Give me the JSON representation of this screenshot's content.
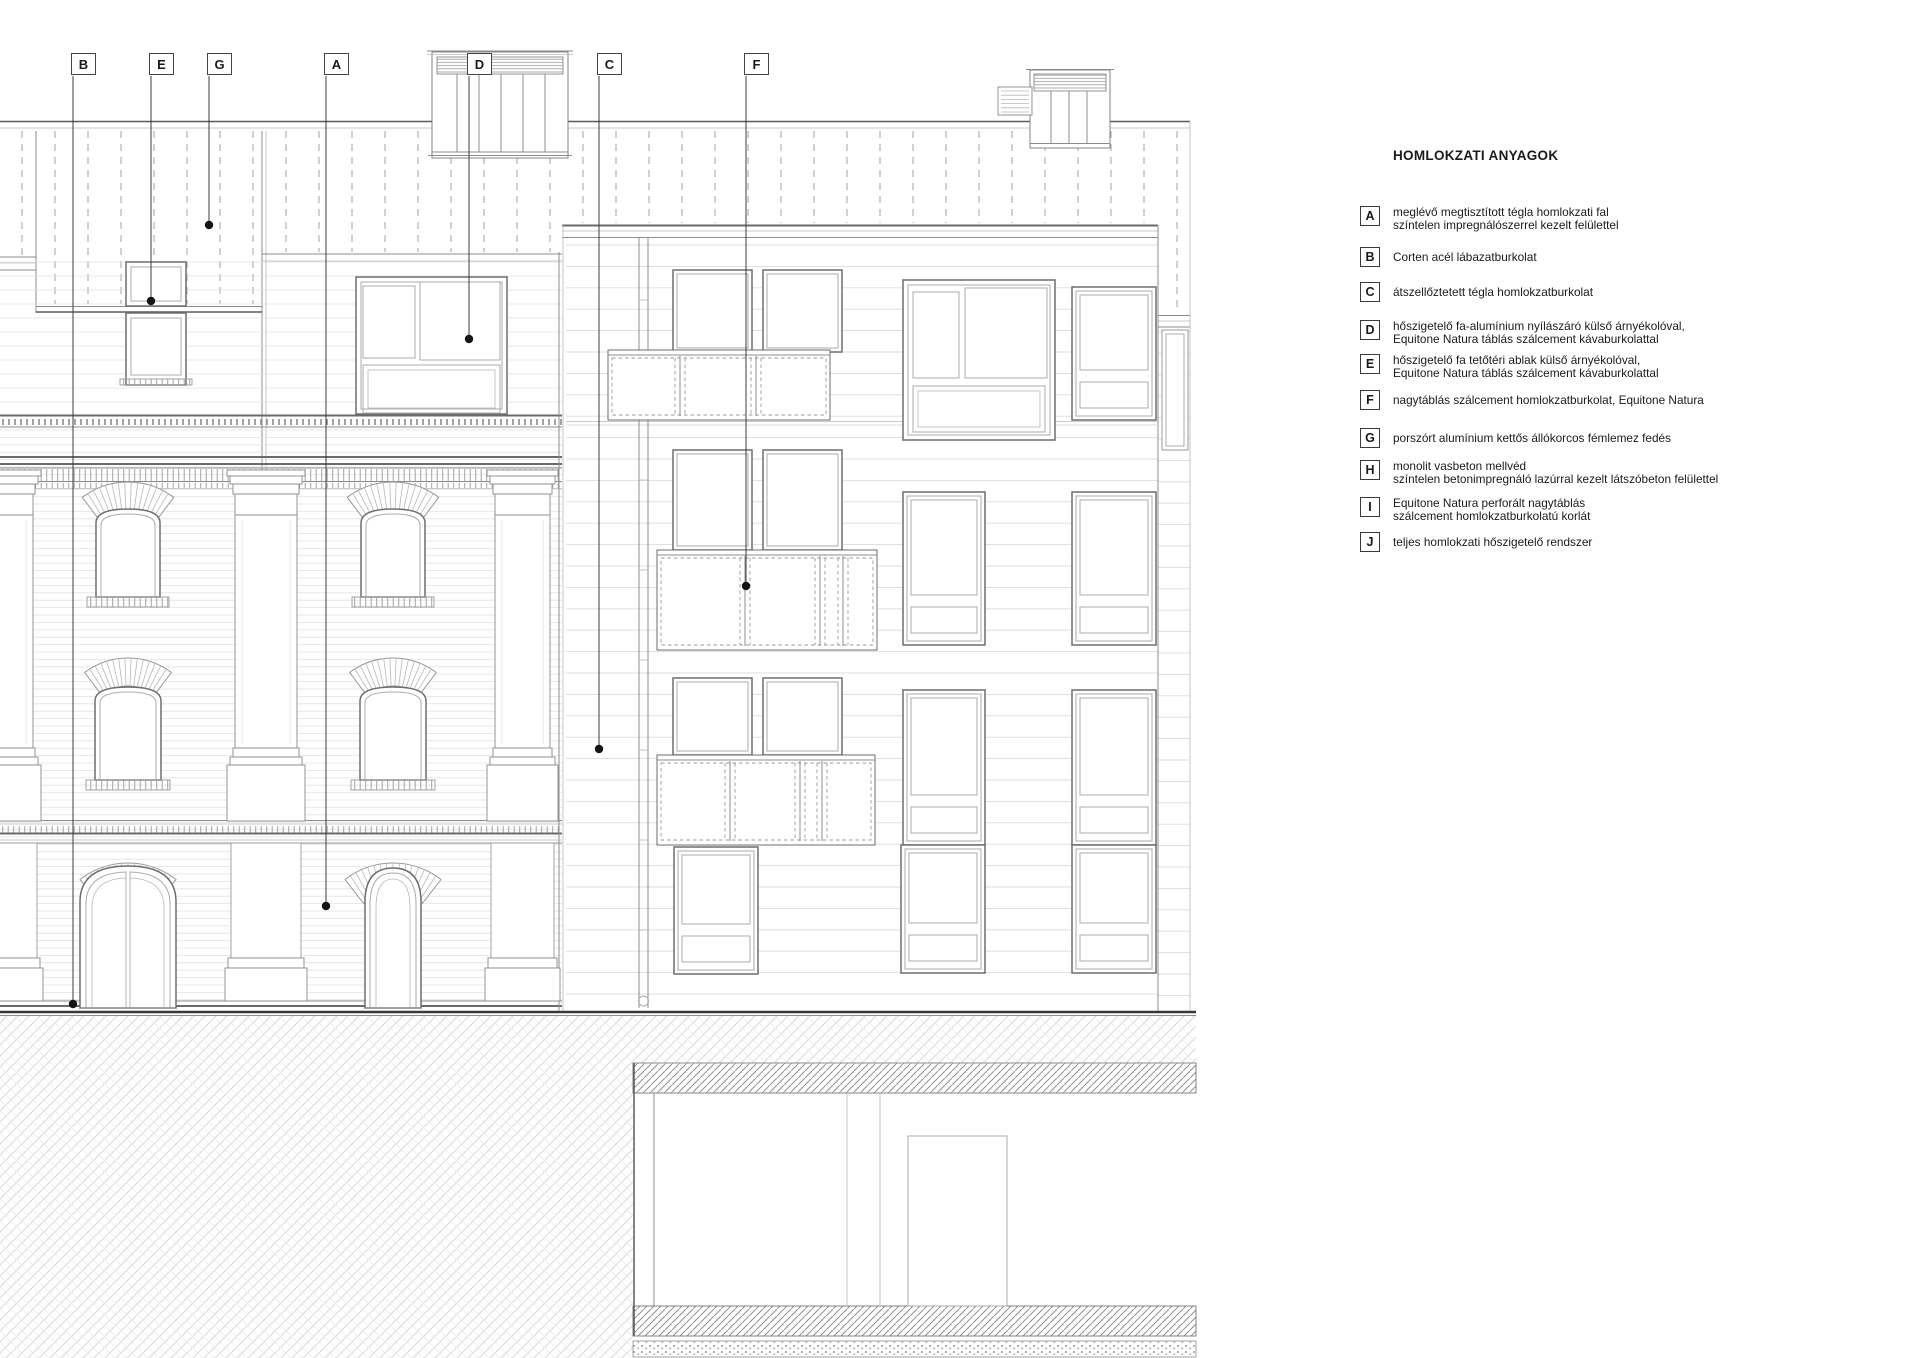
{
  "legend": {
    "title": "HOMLOKZATI ANYAGOK",
    "items": [
      {
        "key": "A",
        "lines": [
          "meglévő megtisztított tégla homlokzati fal",
          "színtelen impregnálószerrel kezelt felülettel"
        ]
      },
      {
        "key": "B",
        "lines": [
          "Corten acél lábazatburkolat"
        ]
      },
      {
        "key": "C",
        "lines": [
          "átszellőztetett tégla homlokzatburkolat"
        ]
      },
      {
        "key": "D",
        "lines": [
          "hőszigetelő fa-alumínium nyílászáró külső árnyékolóval,",
          "Equitone Natura táblás szálcement kávaburkolattal"
        ]
      },
      {
        "key": "E",
        "lines": [
          "hőszigetelő fa tetőtéri ablak külső árnyékolóval,",
          "Equitone Natura táblás szálcement kávaburkolattal"
        ]
      },
      {
        "key": "F",
        "lines": [
          "nagytáblás szálcement homlokzatburkolat, Equitone Natura"
        ]
      },
      {
        "key": "G",
        "lines": [
          "porszórt alumínium kettős állókorcos fémlemez fedés"
        ]
      },
      {
        "key": "H",
        "lines": [
          "monolit vasbeton mellvéd",
          "színtelen betonimpregnáló lazúrral kezelt látszóbeton felülettel"
        ]
      },
      {
        "key": "I",
        "lines": [
          "Equitone Natura perforált nagytáblás",
          "szálcement homlokzatburkolatú korlát"
        ]
      },
      {
        "key": "J",
        "lines": [
          "teljes homlokzati hőszigetelő rendszer"
        ]
      }
    ]
  },
  "callouts": [
    {
      "letter": "B"
    },
    {
      "letter": "E"
    },
    {
      "letter": "G"
    },
    {
      "letter": "A"
    },
    {
      "letter": "D"
    },
    {
      "letter": "C"
    },
    {
      "letter": "F"
    }
  ],
  "colors": {
    "line": "#4a4a4a",
    "light_line": "#c9c9c9",
    "dot": "#141414",
    "background": "#ffffff"
  }
}
